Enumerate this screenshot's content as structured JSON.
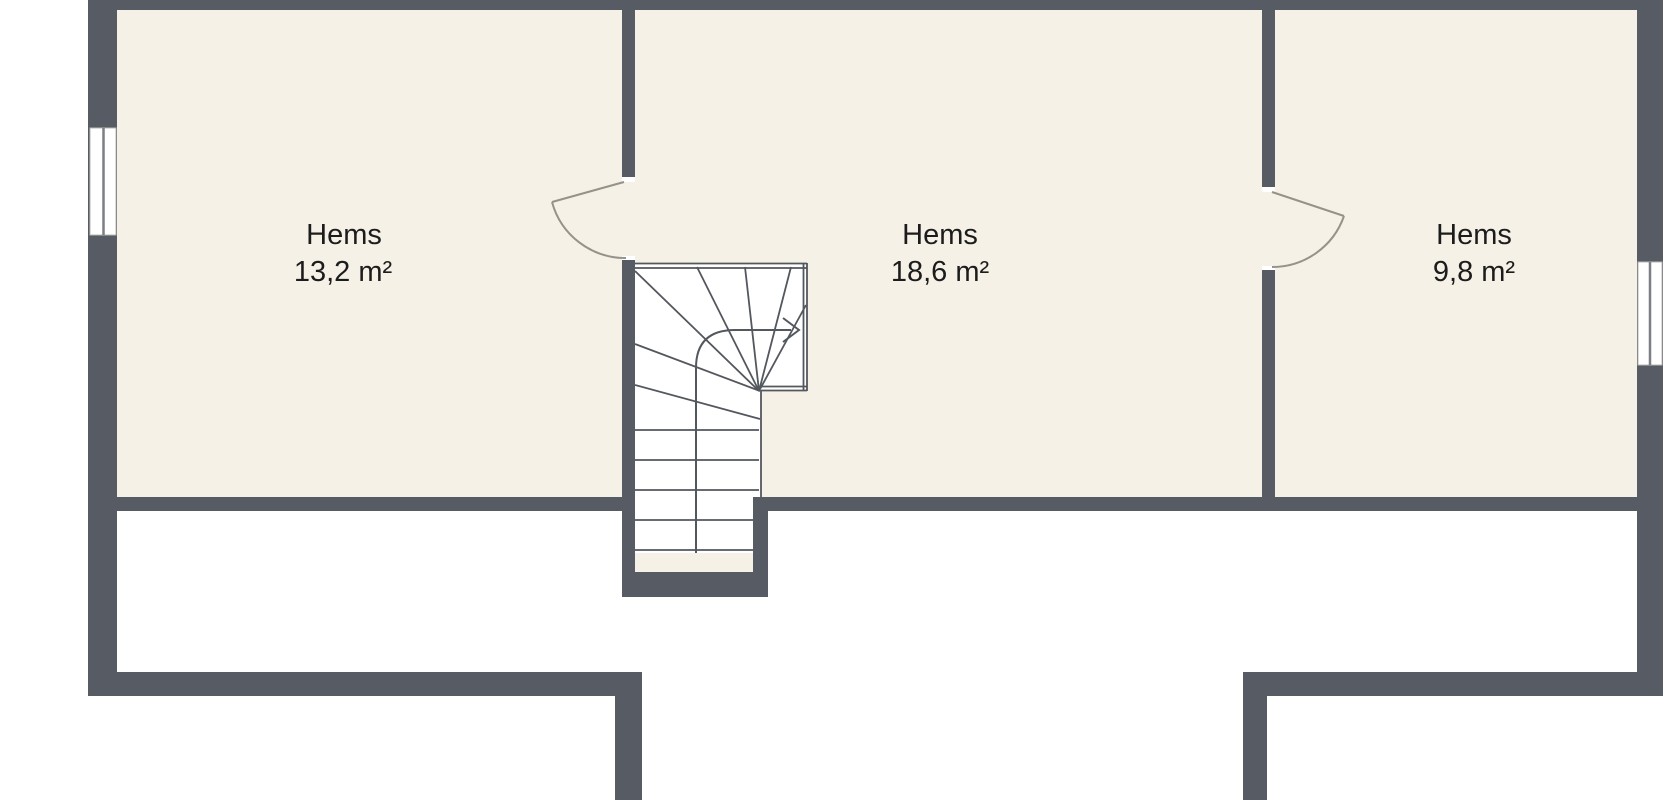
{
  "rooms": [
    {
      "id": "room-left",
      "name": "Hems",
      "area": "13,2 m²"
    },
    {
      "id": "room-middle",
      "name": "Hems",
      "area": "18,6 m²"
    },
    {
      "id": "room-right",
      "name": "Hems",
      "area": "9,8 m²"
    }
  ],
  "icons": {
    "stairs_direction_arrow": "chevron-right"
  },
  "colors": {
    "wall": "#575b63",
    "floor": "#f5f1e6",
    "outside": "#ffffff",
    "stair_line": "#53575e",
    "door_line": "#95928a",
    "window_line": "#7c7f85",
    "text": "#1c1c1c"
  }
}
